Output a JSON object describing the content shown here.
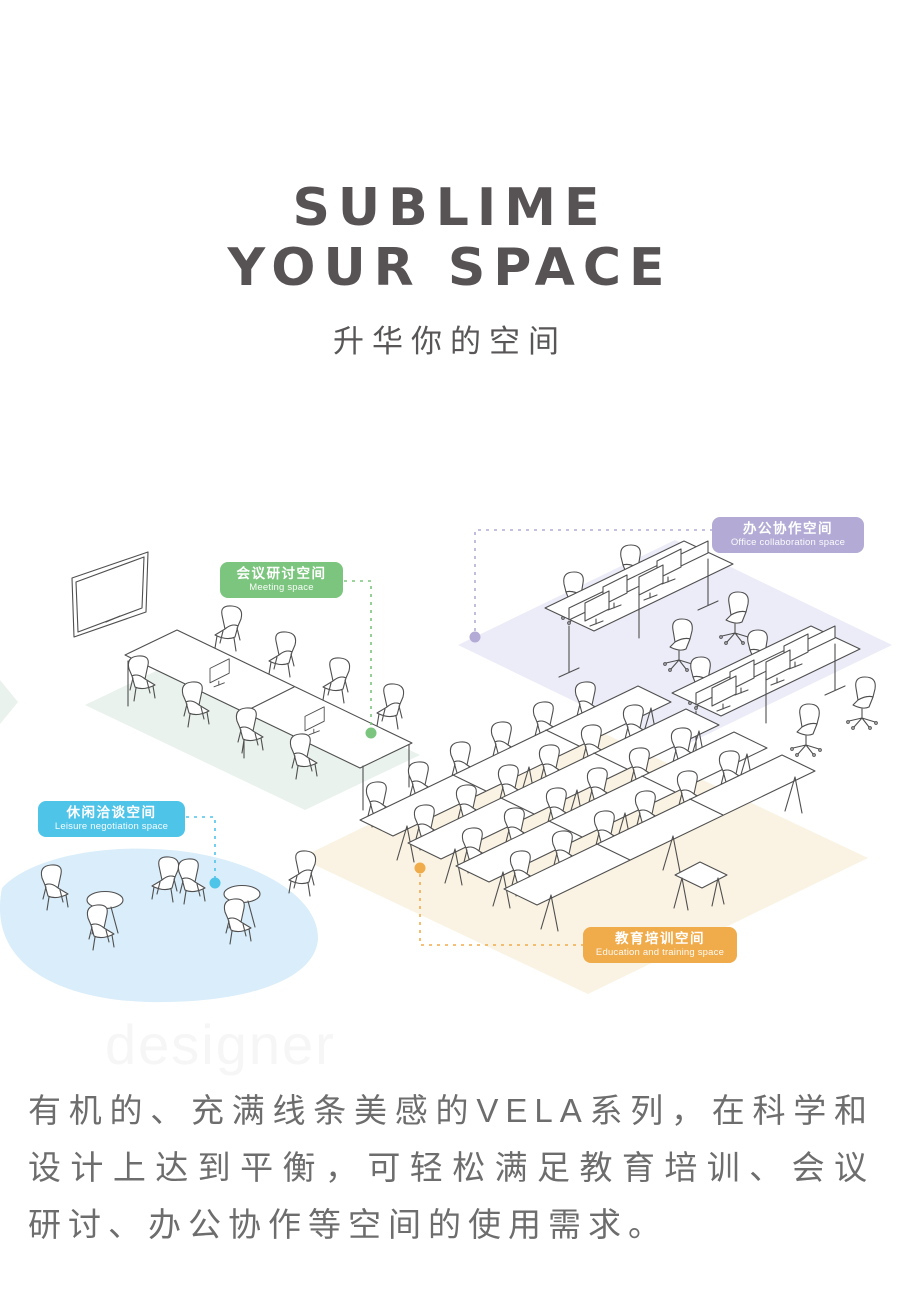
{
  "page": {
    "title_line1": "SUBLIME",
    "title_line2": "YOUR SPACE",
    "subtitle": "升华你的空间",
    "watermark": "designer",
    "body_lines": [
      "有机的、充满线条美感的VELA系列，在科学和",
      "设计上达到平衡，可轻松满足教育培训、会议",
      "研讨、办公协作等空间的使用需求。"
    ],
    "title_color": "#575354",
    "body_text_color": "#6e6d6d"
  },
  "zones": {
    "meeting": {
      "title_zh": "会议研讨空间",
      "title_en": "Meeting space",
      "color": "#7cc57e"
    },
    "office": {
      "title_zh": "办公协作空间",
      "title_en": "Office collaboration space",
      "color": "#b3abd6"
    },
    "leisure": {
      "title_zh": "休闲洽谈空间",
      "title_en": "Leisure negotiation space",
      "color": "#4fc4e9"
    },
    "education": {
      "title_zh": "教育培训空间",
      "title_en": "Education and training space",
      "color": "#f0ab4a"
    }
  },
  "illustration": {
    "line_color": "#4f4f4f",
    "floors": {
      "meeting": "#e9f2ec",
      "office": "#ececf8",
      "leisure": "#d9edfa",
      "education": "#faf3e3"
    }
  }
}
